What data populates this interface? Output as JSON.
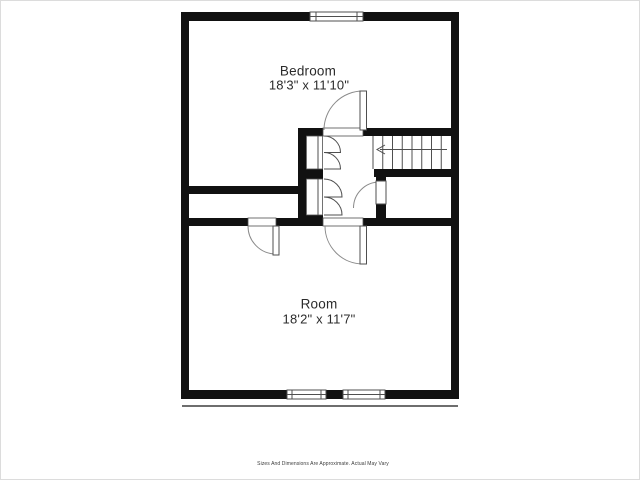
{
  "plan": {
    "rooms": [
      {
        "name": "Bedroom",
        "dimensions": "18'3\" x 11'10\""
      },
      {
        "name": "Room",
        "dimensions": "18'2\" x 11'7\""
      }
    ]
  },
  "footer": {
    "disclaimer": "Sizes And Dimensions Are Approximate. Actual May Vary"
  },
  "colors": {
    "wall": "#111111",
    "text": "#2b2b2b",
    "thin_line": "#4f4f4f",
    "arc_line": "#8a8a8a",
    "background": "#ffffff"
  }
}
